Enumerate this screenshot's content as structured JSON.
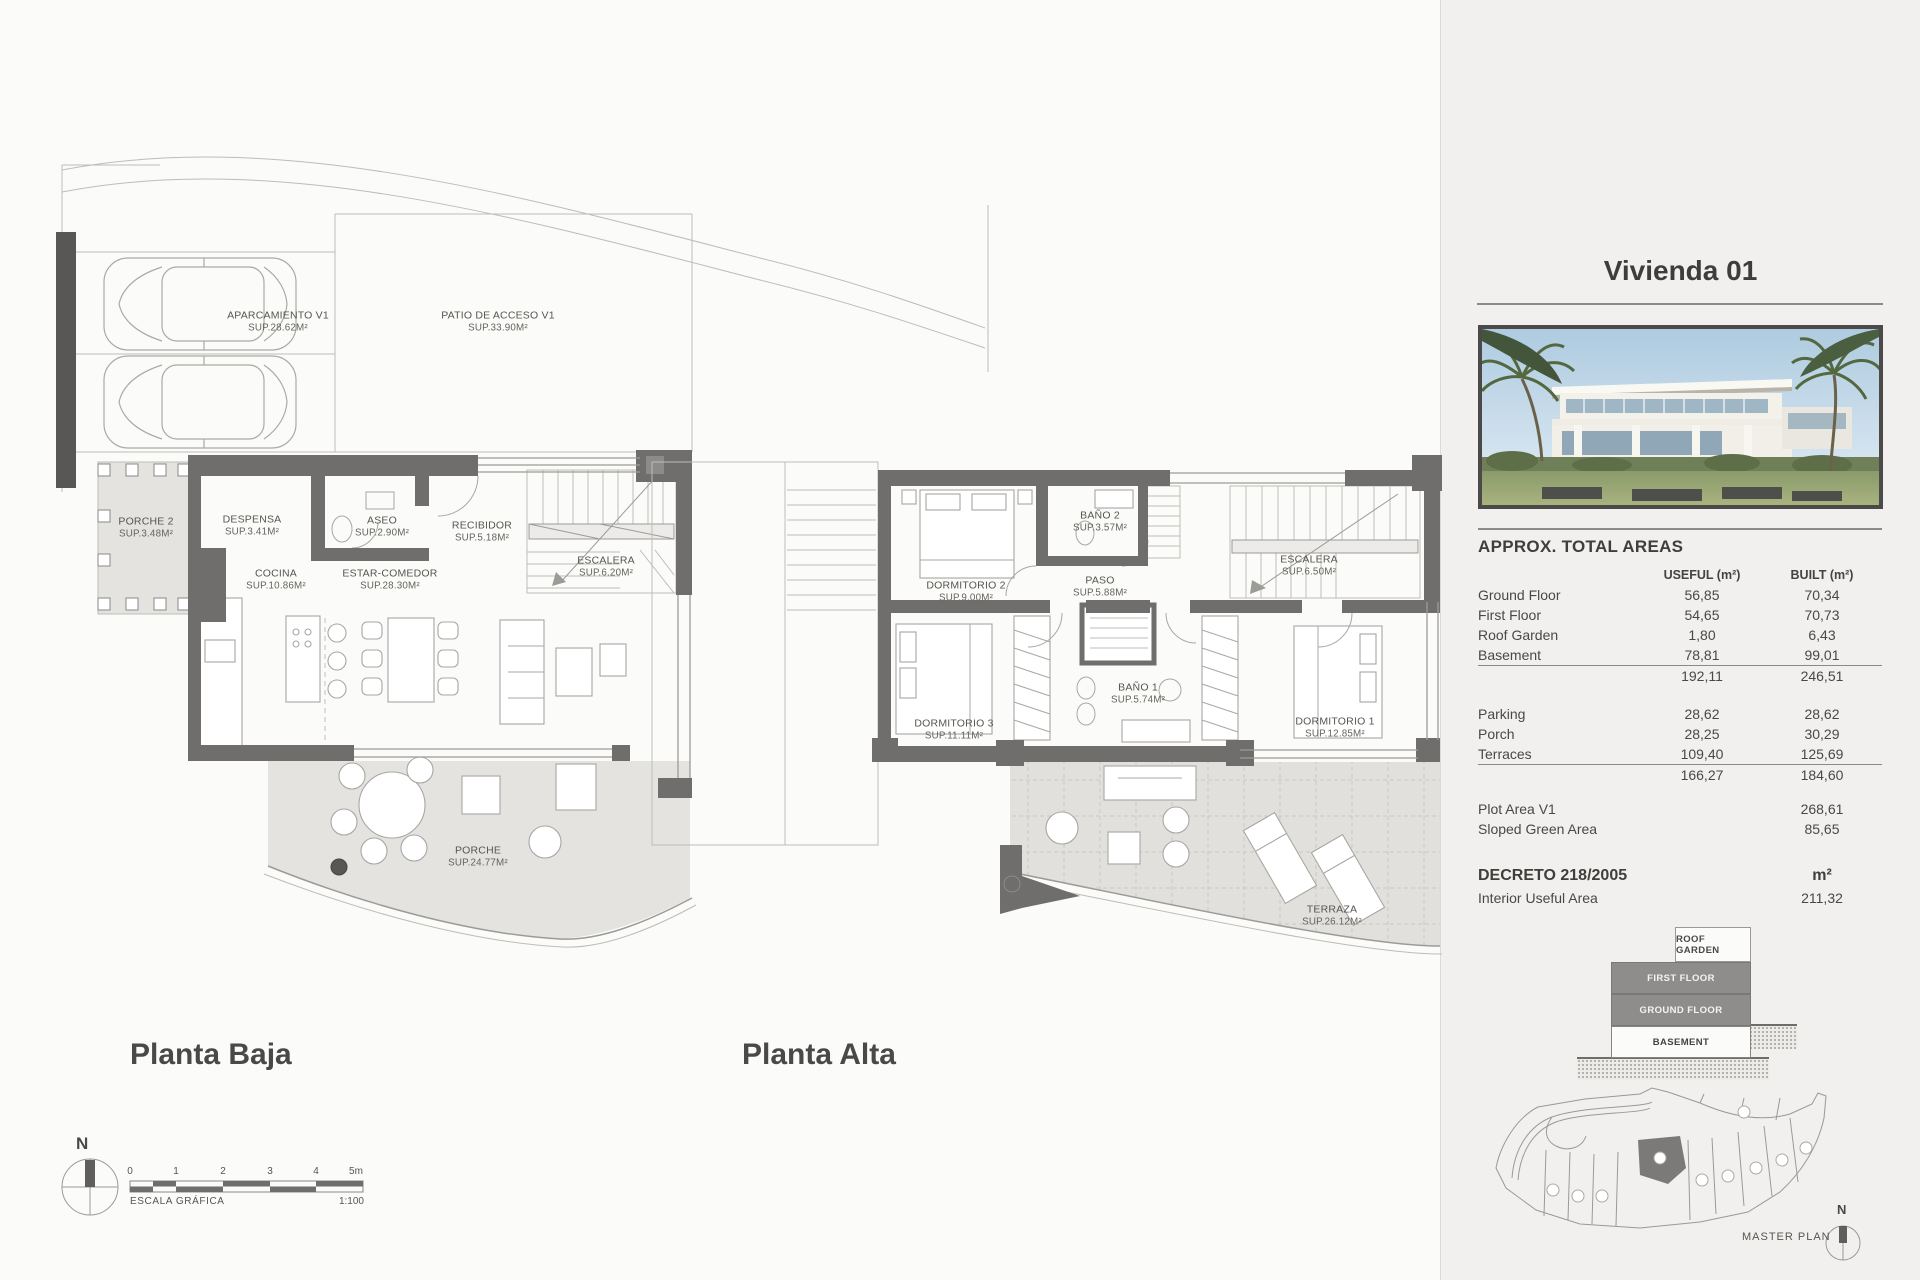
{
  "page": {
    "sheet_bg": "#fbfbf9",
    "panel_bg": "#f1f0ee",
    "wall_color": "#6f6e6c",
    "accent_gray": "#8e8d8b"
  },
  "plans": {
    "baja": {
      "title": "Planta Baja",
      "parking": {
        "name": "APARCAMIENTO V1",
        "sup": "SUP.28.62M²"
      },
      "patio": {
        "name": "PATIO DE ACCESO V1",
        "sup": "SUP.33.90M²"
      },
      "rooms": [
        {
          "name": "PORCHE 2",
          "sup": "SUP.3.48M²"
        },
        {
          "name": "DESPENSA",
          "sup": "SUP.3.41M²"
        },
        {
          "name": "ASEO",
          "sup": "SUP.2.90M²"
        },
        {
          "name": "RECIBIDOR",
          "sup": "SUP.5.18M²"
        },
        {
          "name": "COCINA",
          "sup": "SUP.10.86M²"
        },
        {
          "name": "ESTAR-COMEDOR",
          "sup": "SUP.28.30M²"
        },
        {
          "name": "ESCALERA",
          "sup": "SUP.6.20M²"
        },
        {
          "name": "PORCHE",
          "sup": "SUP.24.77M²"
        }
      ]
    },
    "alta": {
      "title": "Planta Alta",
      "rooms": [
        {
          "name": "DORMITORIO 2",
          "sup": "SUP.9.00M²"
        },
        {
          "name": "BAÑO 2",
          "sup": "SUP.3.57M²"
        },
        {
          "name": "PASO",
          "sup": "SUP.5.88M²"
        },
        {
          "name": "ESCALERA",
          "sup": "SUP.6.50M²"
        },
        {
          "name": "DORMITORIO 3",
          "sup": "SUP.11.11M²"
        },
        {
          "name": "BAÑO 1",
          "sup": "SUP.5.74M²"
        },
        {
          "name": "DORMITORIO 1",
          "sup": "SUP.12.85M²"
        },
        {
          "name": "TERRAZA",
          "sup": "SUP.26.12M²"
        }
      ]
    }
  },
  "scalebar": {
    "label": "ESCALA GRÁFICA",
    "ratio": "1:100",
    "north": "N",
    "ticks": [
      "0",
      "1",
      "2",
      "3",
      "4",
      "5m"
    ]
  },
  "panel": {
    "title": "Vivienda 01",
    "areas": {
      "heading": "APPROX. TOTAL AREAS",
      "col_useful": "USEFUL (m²)",
      "col_built": "BUILT (m²)",
      "rows": [
        {
          "label": "Ground Floor",
          "useful": "56,85",
          "built": "70,34"
        },
        {
          "label": "First Floor",
          "useful": "54,65",
          "built": "70,73"
        },
        {
          "label": "Roof Garden",
          "useful": "1,80",
          "built": "6,43"
        },
        {
          "label": "Basement",
          "useful": "78,81",
          "built": "99,01"
        }
      ],
      "subtotal1": {
        "useful": "192,11",
        "built": "246,51"
      },
      "rows2": [
        {
          "label": "Parking",
          "useful": "28,62",
          "built": "28,62"
        },
        {
          "label": "Porch",
          "useful": "28,25",
          "built": "30,29"
        },
        {
          "label": "Terraces",
          "useful": "109,40",
          "built": "125,69"
        }
      ],
      "subtotal2": {
        "useful": "166,27",
        "built": "184,60"
      },
      "plot": {
        "label": "Plot Area V1",
        "built": "268,61"
      },
      "sloped": {
        "label": "Sloped Green Area",
        "built": "85,65"
      },
      "decreto": {
        "label": "DECRETO 218/2005",
        "unit": "m²"
      },
      "interior": {
        "label": "Interior Useful Area",
        "built": "211,32"
      }
    },
    "stack": {
      "roof": "ROOF GARDEN",
      "first": "FIRST FLOOR",
      "ground": "GROUND FLOOR",
      "basement": "BASEMENT"
    },
    "masterplan": {
      "label": "MASTER PLAN",
      "north": "N"
    }
  }
}
